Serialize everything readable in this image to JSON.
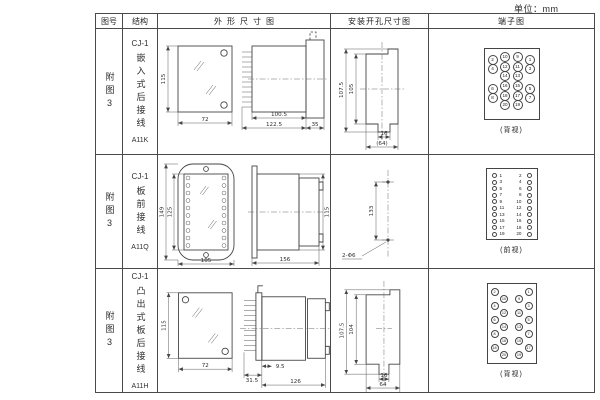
{
  "unit_label": "单位：mm",
  "headers": {
    "fig_no": "图号",
    "structure": "结构",
    "outline": "外形尺寸图",
    "install": "安装开孔尺寸图",
    "terminal": "端子图"
  },
  "rows": [
    {
      "fig_no": "附图3",
      "structure": {
        "model": "CJ-1",
        "type": "嵌入式后接线",
        "code": "A11K"
      },
      "outline_dims": {
        "front_height": "115",
        "front_width": "72",
        "body_length": "100.5",
        "total_length": "122.5",
        "flange_depth": "35"
      },
      "install_dims": {
        "outer_height": "107.5",
        "inner_height": "105",
        "slot_width": "16",
        "total_width": "(64)"
      },
      "terminal": {
        "caption": "(背视)",
        "grid": [
          [
            "2",
            "10",
            "9",
            "1"
          ],
          [
            "4",
            "12",
            "11",
            "3"
          ],
          [
            "",
            "14",
            "13",
            ""
          ],
          [
            "6",
            "16",
            "15",
            "5"
          ],
          [
            "8",
            "18",
            "17",
            "7"
          ],
          [
            "",
            "20",
            "19",
            ""
          ]
        ]
      }
    },
    {
      "fig_no": "附图3",
      "structure": {
        "model": "CJ-1",
        "type": "板前接线",
        "code": "A11Q"
      },
      "outline_dims": {
        "front_outer_height": "149",
        "front_inner_height": "125",
        "front_width": "105",
        "side_length": "156",
        "side_height": "115"
      },
      "install_dims": {
        "hole_spacing": "133",
        "holes_label": "2-Φ6"
      },
      "terminal": {
        "caption": "(前视)",
        "left": [
          "1",
          "3",
          "5",
          "7",
          "9",
          "11",
          "13",
          "15",
          "17",
          "19"
        ],
        "right": [
          "2",
          "4",
          "6",
          "8",
          "10",
          "12",
          "14",
          "16",
          "18",
          "20"
        ]
      }
    },
    {
      "fig_no": "附图3",
      "structure": {
        "model": "CJ-1",
        "type": "凸出式板后接线",
        "code": "A11H"
      },
      "outline_dims": {
        "front_height": "115",
        "front_width": "72",
        "pin_depth": "9.5",
        "front_depth": "31.5",
        "body_length": "126"
      },
      "install_dims": {
        "outer_height": "107.5",
        "inner_height": "104",
        "slot_width": "16",
        "total_width": "64"
      },
      "terminal": {
        "caption": "(背视)",
        "left": [
          "2",
          "10",
          "4",
          "12",
          "6",
          "14",
          "8",
          "16",
          "18",
          "20"
        ],
        "right": [
          "1",
          "9",
          "3",
          "11",
          "5",
          "13",
          "7",
          "15",
          "17",
          "19"
        ]
      }
    }
  ]
}
